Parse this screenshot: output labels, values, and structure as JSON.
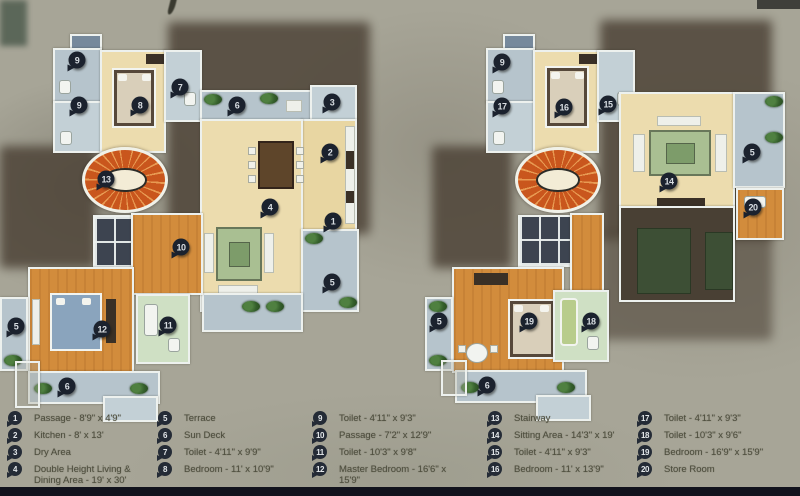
{
  "title": "Duplex Floor Plans",
  "colors": {
    "background": "#a7a597",
    "wall": "#edf1ee",
    "floor_cream": "#ecdcae",
    "floor_wood": "#d28c3c",
    "floor_terrace": "#b6c4cc",
    "stairs_orange": "#c9561d",
    "pin_dark": "#1b222e",
    "legend_text": "#4e4e3e",
    "bottom_bar": "#12131d"
  },
  "plans": [
    {
      "name": "lower-floor-plan",
      "container": "plan-left-markers",
      "markers": [
        {
          "n": "9",
          "x": 77,
          "y": 60
        },
        {
          "n": "9",
          "x": 79,
          "y": 105
        },
        {
          "n": "8",
          "x": 140,
          "y": 105
        },
        {
          "n": "7",
          "x": 180,
          "y": 87
        },
        {
          "n": "6",
          "x": 237,
          "y": 105
        },
        {
          "n": "3",
          "x": 332,
          "y": 102
        },
        {
          "n": "2",
          "x": 330,
          "y": 152
        },
        {
          "n": "13",
          "x": 106,
          "y": 179
        },
        {
          "n": "4",
          "x": 270,
          "y": 207
        },
        {
          "n": "1",
          "x": 333,
          "y": 221
        },
        {
          "n": "10",
          "x": 181,
          "y": 247
        },
        {
          "n": "5",
          "x": 332,
          "y": 282
        },
        {
          "n": "5",
          "x": 16,
          "y": 326
        },
        {
          "n": "12",
          "x": 102,
          "y": 329
        },
        {
          "n": "11",
          "x": 168,
          "y": 325
        },
        {
          "n": "6",
          "x": 67,
          "y": 386
        }
      ]
    },
    {
      "name": "upper-floor-plan",
      "container": "plan-right-markers",
      "markers": [
        {
          "n": "9",
          "x": 502,
          "y": 62
        },
        {
          "n": "17",
          "x": 502,
          "y": 106
        },
        {
          "n": "16",
          "x": 564,
          "y": 107
        },
        {
          "n": "15",
          "x": 608,
          "y": 104
        },
        {
          "n": "5",
          "x": 752,
          "y": 152
        },
        {
          "n": "14",
          "x": 669,
          "y": 181
        },
        {
          "n": "20",
          "x": 753,
          "y": 207
        },
        {
          "n": "5",
          "x": 439,
          "y": 321
        },
        {
          "n": "19",
          "x": 529,
          "y": 321
        },
        {
          "n": "18",
          "x": 591,
          "y": 321
        },
        {
          "n": "6",
          "x": 487,
          "y": 385
        }
      ]
    }
  ],
  "legend": {
    "columns": [
      {
        "x": 8,
        "entries": [
          {
            "num": "1",
            "label": "Passage - 8'9\" x 4'9\""
          },
          {
            "num": "2",
            "label": "Kitchen - 8' x 13'"
          },
          {
            "num": "3",
            "label": "Dry Area"
          },
          {
            "num": "4",
            "label": "Double Height Living & Dining Area - 19' x 30'"
          }
        ]
      },
      {
        "x": 158,
        "entries": [
          {
            "num": "5",
            "label": "Terrace"
          },
          {
            "num": "6",
            "label": "Sun Deck"
          },
          {
            "num": "7",
            "label": "Toilet - 4'11\" x 9'9\""
          },
          {
            "num": "8",
            "label": "Bedroom - 11' x 10'9\""
          }
        ]
      },
      {
        "x": 313,
        "entries": [
          {
            "num": "9",
            "label": "Toilet - 4'11\" x 9'3\""
          },
          {
            "num": "10",
            "label": "Passage - 7'2\" x 12'9\""
          },
          {
            "num": "11",
            "label": "Toilet - 10'3\" x 9'8\""
          },
          {
            "num": "12",
            "label": "Master Bedroom - 16'6\" x 15'9\""
          }
        ]
      },
      {
        "x": 488,
        "entries": [
          {
            "num": "13",
            "label": "Stairway"
          },
          {
            "num": "14",
            "label": "Sitting Area - 14'3\" x 19'"
          },
          {
            "num": "15",
            "label": "Toilet - 4'11\" x 9'3\""
          },
          {
            "num": "16",
            "label": "Bedroom - 11' x 13'9\""
          }
        ]
      },
      {
        "x": 638,
        "entries": [
          {
            "num": "17",
            "label": "Toilet - 4'11\" x 9'3\""
          },
          {
            "num": "18",
            "label": "Toilet - 10'3\" x 9'6\""
          },
          {
            "num": "19",
            "label": "Bedroom - 16'9\" x 15'9\""
          },
          {
            "num": "20",
            "label": "Store Room"
          }
        ]
      }
    ]
  }
}
